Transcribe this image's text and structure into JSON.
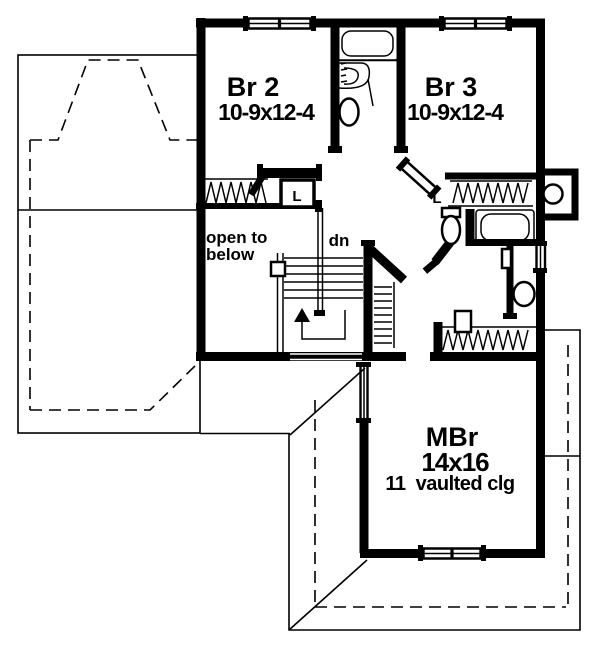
{
  "plan": {
    "type": "second-floor-plan",
    "background_color": "#ffffff",
    "line_color": "#000000",
    "rooms": {
      "br2": {
        "name": "Br 2",
        "dims": "10-9x12-4"
      },
      "br3": {
        "name": "Br 3",
        "dims": "10-9x12-4"
      },
      "mbr": {
        "name": "MBr",
        "dims": "14x16",
        "ceiling": "11  vaulted clg"
      },
      "open_to_below": {
        "line1": "open to",
        "line2": "below"
      }
    },
    "labels": {
      "stair_direction": "dn",
      "linen_left": "L",
      "linen_right": "L"
    }
  }
}
